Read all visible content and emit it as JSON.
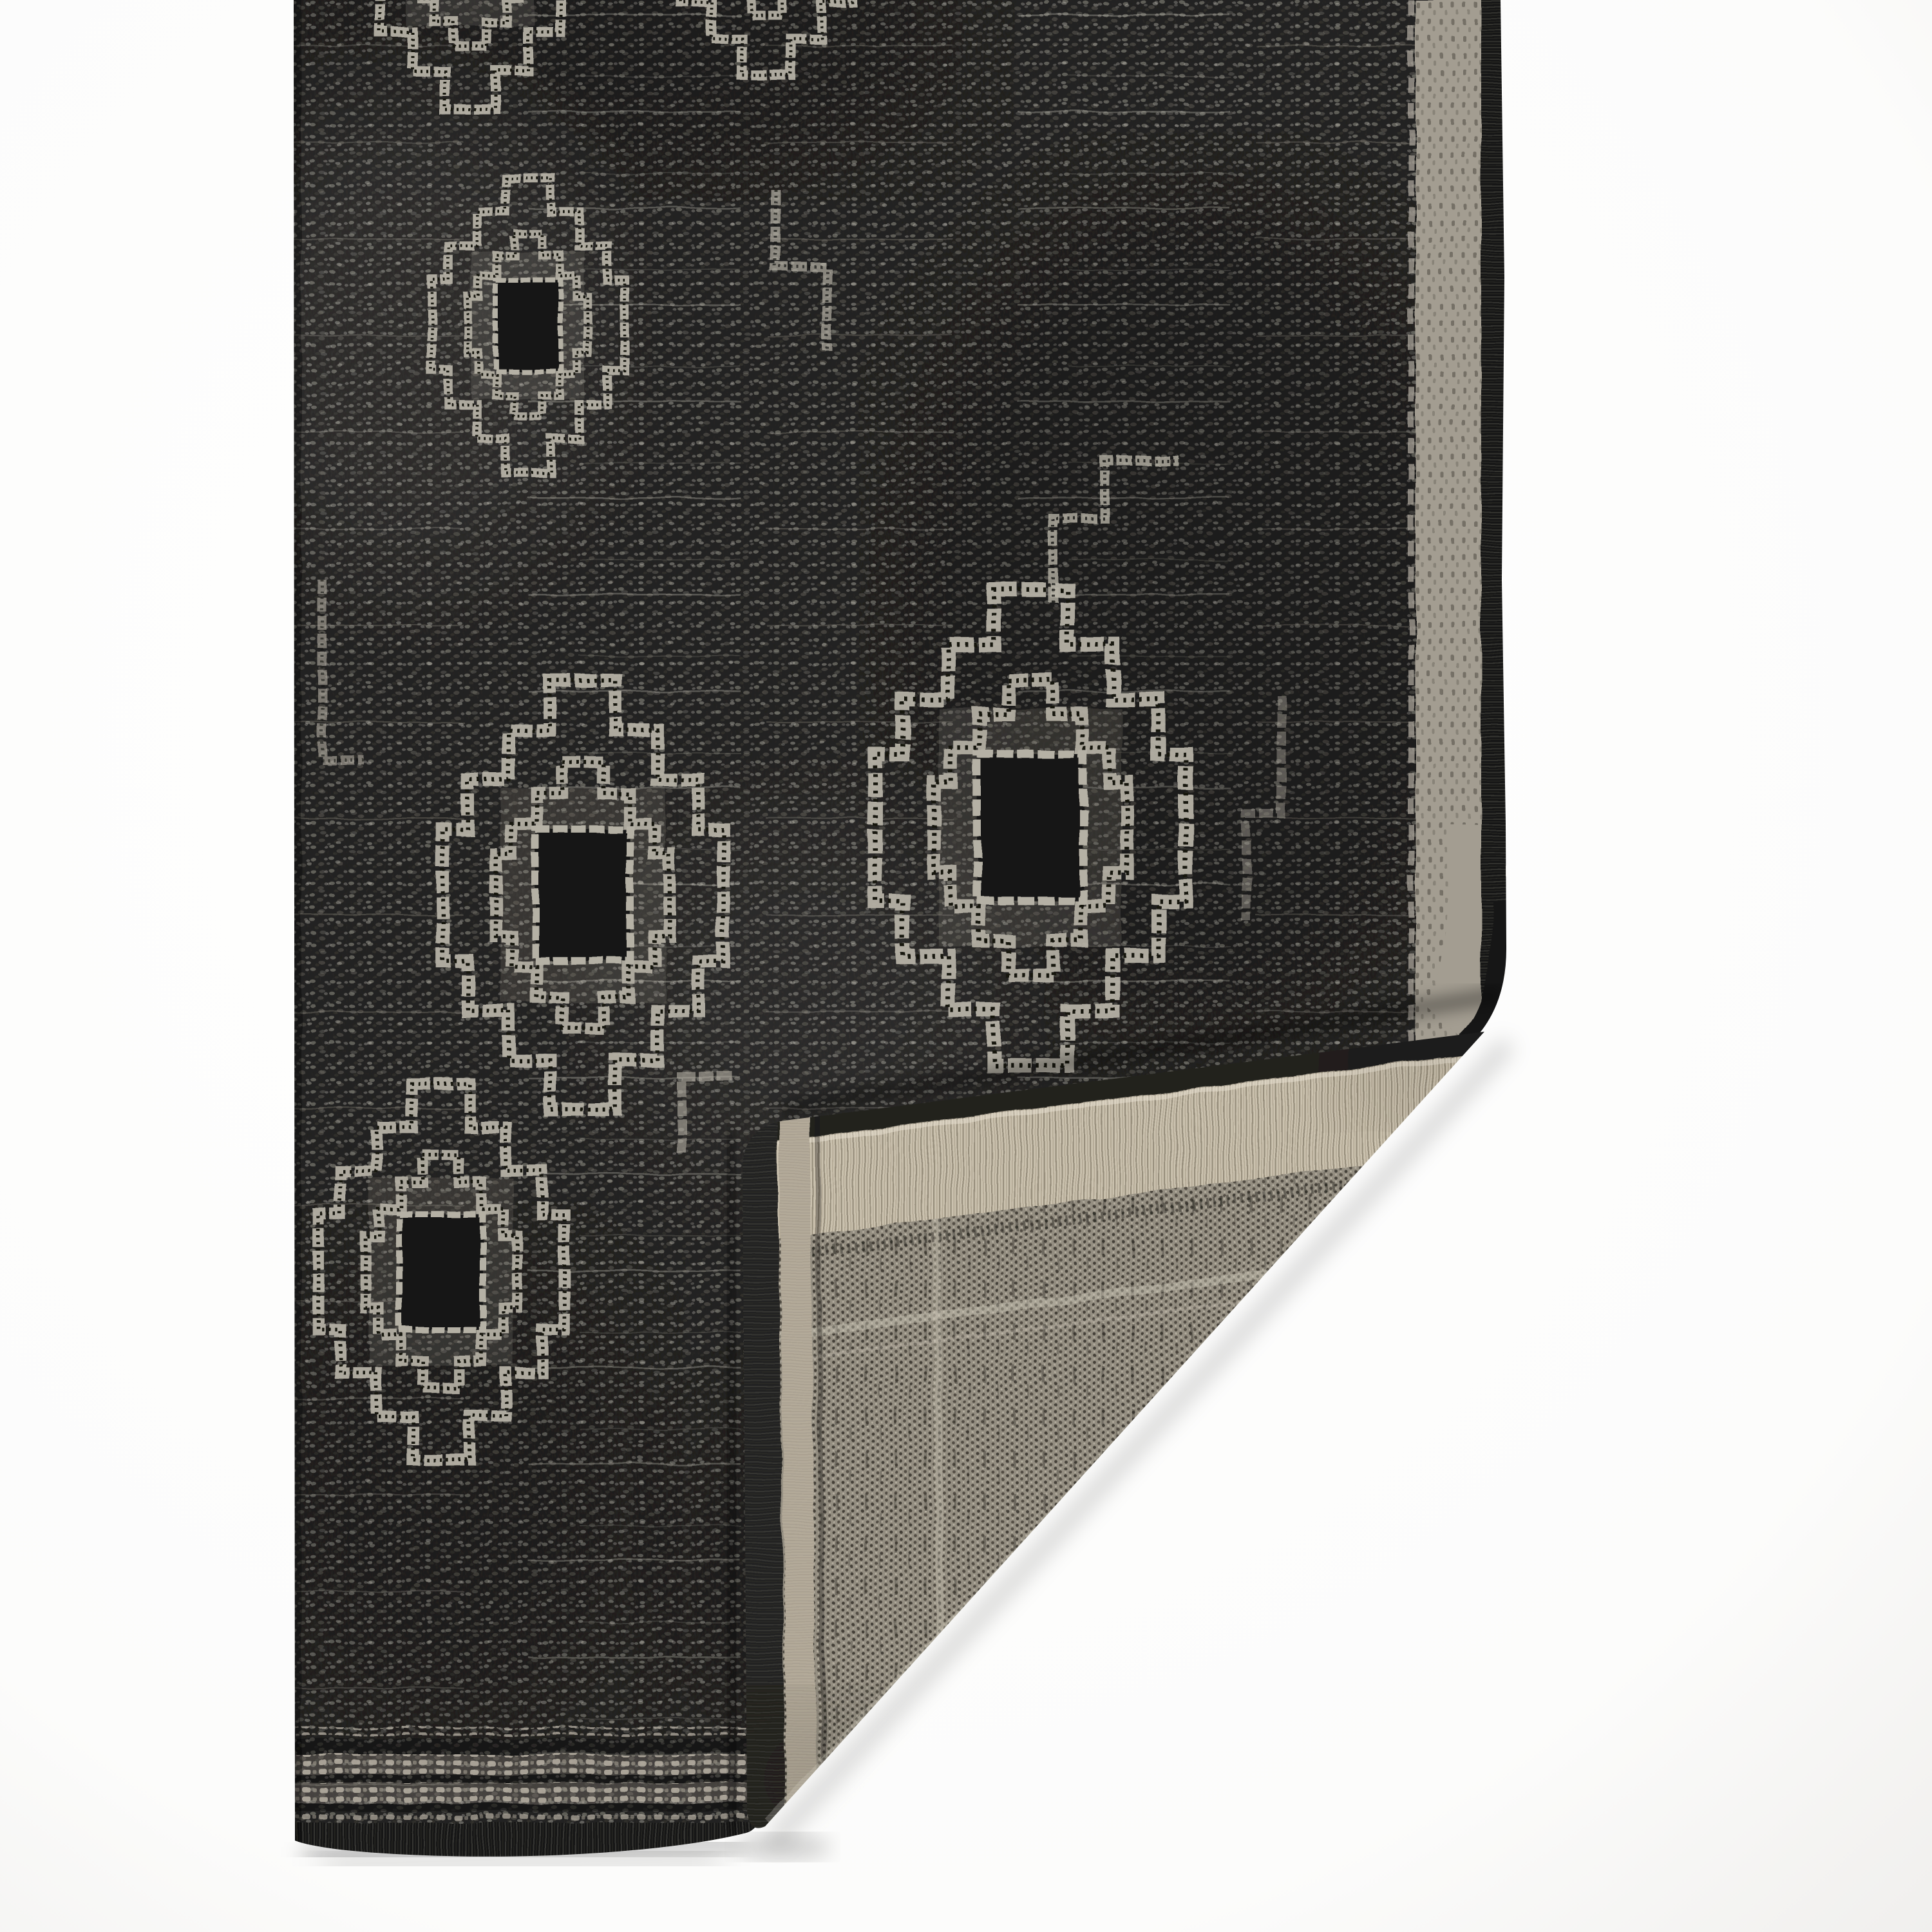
{
  "image": {
    "alt": "Product photograph: corner detail of a charcoal black flat-weave indoor-outdoor rug with light gray stepped geometric tribal medallion pattern; the bottom-right corner is folded over revealing the gray-taupe woven backing, on a plain white background",
    "type": "product-photo",
    "subject": "area rug corner fold detail"
  },
  "rug": {
    "front": {
      "field": "heathered charcoal black flatweave",
      "motifs": "light gray stepped medallions and key hooks with dark stitched ladder lines",
      "side_border": "light gray band with dark serged edge",
      "bottom_border": "three light gray broken stripes above dark serged edge"
    },
    "fold": {
      "state": "bottom-right corner folded over on top of rug",
      "reveals": "woven backing",
      "top_edge": "dark rolled edge with tan selvedge band",
      "left_edge": "dark charcoal serged binding strip"
    },
    "backing": {
      "texture": "gray-taupe dotted basketweave with faint lighter frame lines and vertical dashes"
    },
    "background": "white seamless studio backdrop with soft shadows under edges"
  },
  "palette": {
    "background": "#ffffff",
    "front_field": "#222120",
    "motif_light": "#b5b1a5",
    "motif_dark": "#121210",
    "border_band": "#a39d91",
    "serge_dark": "#191917",
    "backing_field": "#948e81",
    "backing_tan": "#cbc2af",
    "binding_dark": "#232220",
    "shadow": "rgba(0,0,0,0.25)"
  }
}
